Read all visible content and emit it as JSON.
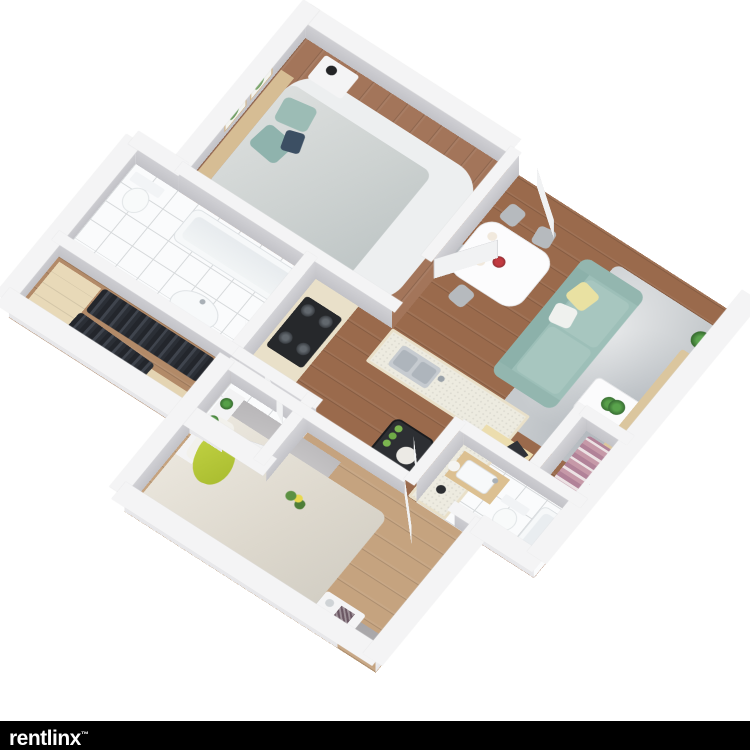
{
  "branding": {
    "logo": "rentlinx",
    "trademark": "™",
    "bar_color": "#000000",
    "text_color": "#ffffff"
  },
  "floor_plan": {
    "type": "3d-isometric-apartment-render",
    "palette": {
      "background": "#ffffff",
      "wall_interior": "#c6c6ca",
      "wall_top": "#f4f4f5",
      "wall_exterior": "#ececef",
      "wood_floor": "#9a6a4c",
      "bedroom1_floor": "#a3755a",
      "bedroom2_floor": "#c5a37f",
      "closet_floor": "#b28a68",
      "tile_floor": "#fafbfc",
      "sofa": "#9dbfb8",
      "pillow_yellow": "#e9e1a2",
      "pillow_teal": "#9cbcb5",
      "pillow_lime": "#b5c837",
      "rug_living": "#c6cacd",
      "rug_bedroom2": "#b7b5b7",
      "rug_bedroom1": "#edeff0",
      "counter_base": "#e9e0c9",
      "cooktop": "#26282b",
      "tv": "#26282c",
      "headboard_wood": "#d6bd94"
    },
    "rooms": [
      {
        "name": "Bedroom 1",
        "features": [
          "double bed with gray bedding",
          "two teal pillows",
          "navy accent pillow",
          "wood headboard",
          "two framed cactus prints",
          "nightstand with black lamp",
          "second nightstand",
          "white shag rug",
          "open swing door"
        ]
      },
      {
        "name": "Living Room",
        "features": [
          "teal three-seat sofa",
          "yellow throw pillow",
          "white throw pillow",
          "gray area rug",
          "white coffee table with potted plant",
          "wood TV console",
          "flat-screen TV",
          "potted plants",
          "window in north wall",
          "entry door"
        ]
      },
      {
        "name": "Dining Nook",
        "features": [
          "white dining table",
          "four gray chairs",
          "red flower vase",
          "place settings"
        ]
      },
      {
        "name": "Kitchen",
        "features": [
          "L-shaped beige counter",
          "stainless sink with faucet",
          "black four-burner gas cooktop",
          "black side table with green bottles and tray",
          "kettle"
        ]
      },
      {
        "name": "Bathroom 1",
        "features": [
          "white tile floor",
          "bathtub",
          "toilet",
          "oval sink",
          "swing door"
        ]
      },
      {
        "name": "Walk-in Closet",
        "features": [
          "light wood wardrobes",
          "rows of dark hanging clothes",
          "wood floor"
        ]
      },
      {
        "name": "Utility Hall",
        "features": [
          "white tile floor",
          "two swing doors",
          "beige cabinet"
        ]
      },
      {
        "name": "Bedroom 2",
        "features": [
          "bed with cream duvet",
          "lime green pillow",
          "white pillow",
          "flower decoration on bed",
          "gray shag rug",
          "white shelf with two plants",
          "nightstand with vase",
          "swing door"
        ]
      },
      {
        "name": "Bathroom 2",
        "features": [
          "white tile floor",
          "wood vanity with sink",
          "toilet",
          "bathtub",
          "swing door"
        ]
      },
      {
        "name": "Closet 2",
        "features": [
          "row of pink and white hanging clothes",
          "cream bench",
          "dark throw"
        ]
      }
    ]
  }
}
